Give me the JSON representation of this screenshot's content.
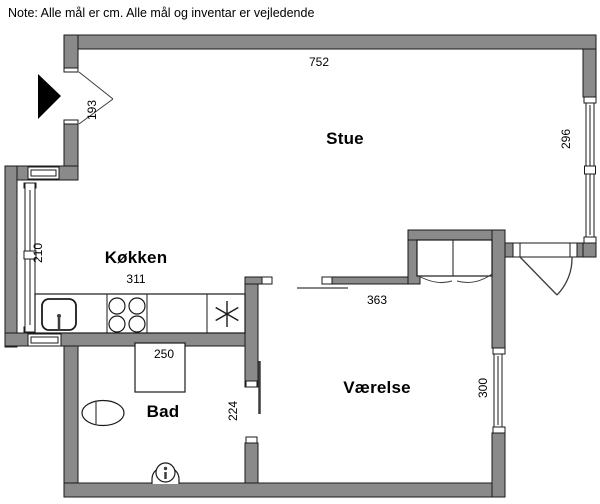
{
  "note": "Note: Alle mål er cm. Alle mål og inventar er vejledende",
  "rooms": {
    "stue": {
      "label": "Stue",
      "width_cm": "752",
      "depth_cm": "296"
    },
    "kokken": {
      "label": "Køkken",
      "width_cm": "311",
      "window_cm": "210"
    },
    "bad": {
      "label": "Bad",
      "width_cm": "250",
      "depth_cm": "224"
    },
    "vaerelse": {
      "label": "Værelse",
      "width_cm": "363",
      "depth_cm": "300"
    }
  },
  "entry": {
    "dimension_cm": "193"
  },
  "fixtures": {
    "entry": [
      "entrance-arrow-icon",
      "entrance-door"
    ],
    "kokken": [
      "kitchen-counter",
      "sink-icon",
      "stove-burners-icon",
      "freezer-snowflake-icon"
    ],
    "bad": [
      "shower-icon",
      "toilet-icon",
      "washbasin-icon",
      "sliding-door"
    ],
    "vaerelse": [
      "wardrobe-icon",
      "door-swing",
      "window"
    ],
    "stue": [
      "window"
    ]
  },
  "colors": {
    "wall": "#8a8a8a",
    "outline": "#1a1a1a",
    "detail": "#3c3c3c",
    "bg": "#ffffff",
    "text": "#000000",
    "arrow": "#000000"
  }
}
